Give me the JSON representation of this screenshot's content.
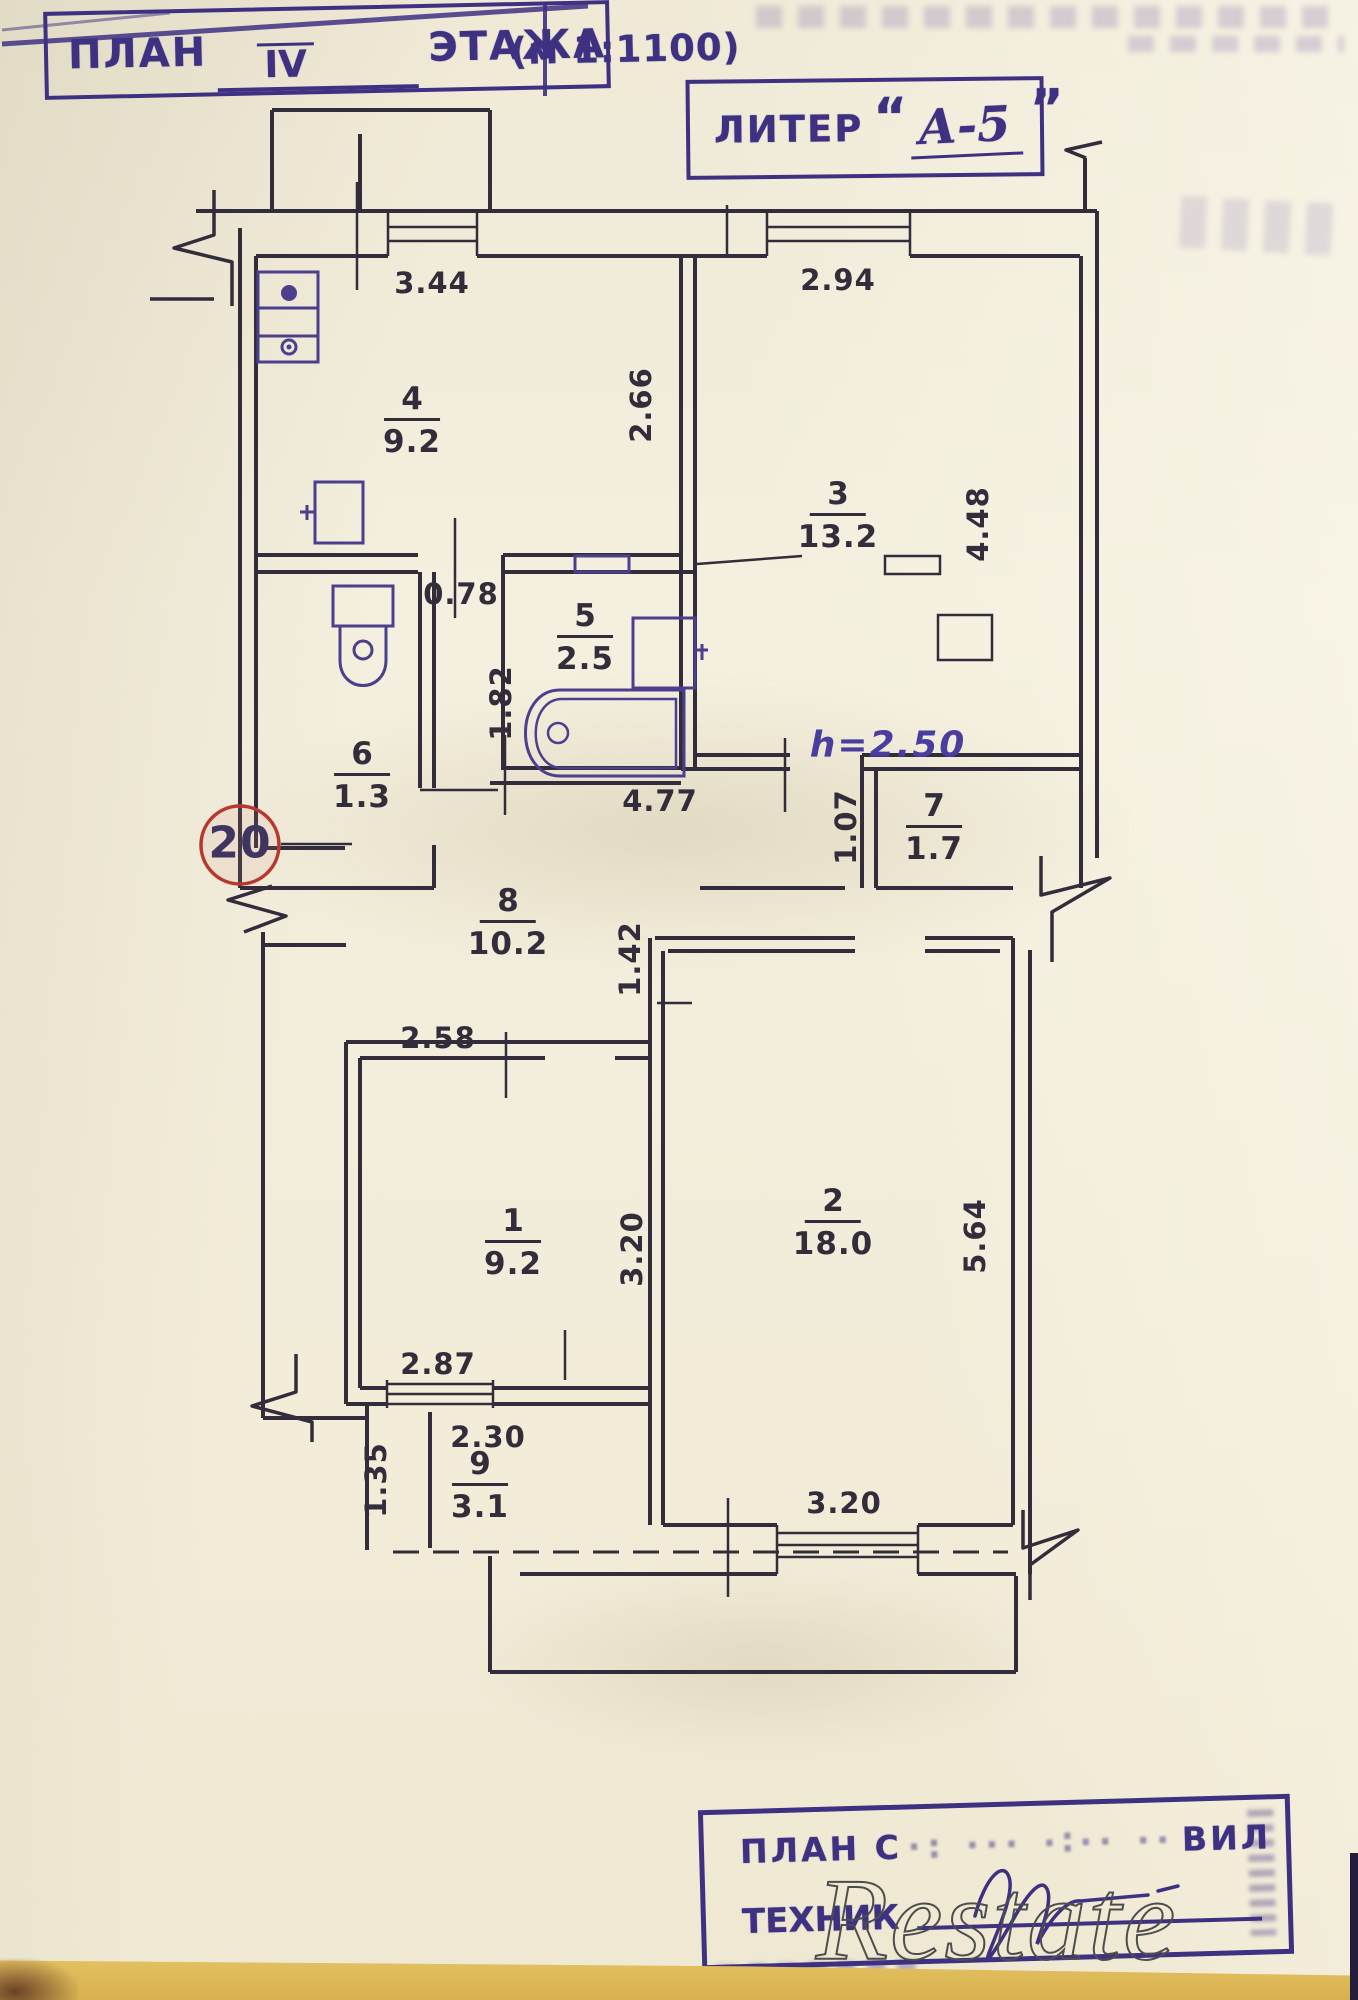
{
  "header_stamp": {
    "word_plan": "ПЛАН",
    "floor_value": "IV",
    "word_floor": "ЭТАЖА",
    "scale_note": "(м 1:1100)"
  },
  "liter_stamp": {
    "label": "ЛИТЕР",
    "quote_open": "“",
    "value": "А-5",
    "quote_close": "”"
  },
  "plan": {
    "apartment_circle": "20",
    "height_note": "h=2.50",
    "rooms": [
      {
        "num": "1",
        "area": "9.2"
      },
      {
        "num": "2",
        "area": "18.0"
      },
      {
        "num": "3",
        "area": "13.2"
      },
      {
        "num": "4",
        "area": "9.2"
      },
      {
        "num": "5",
        "area": "2.5"
      },
      {
        "num": "6",
        "area": "1.3"
      },
      {
        "num": "7",
        "area": "1.7"
      },
      {
        "num": "8",
        "area": "10.2"
      },
      {
        "num": "9",
        "area": "3.1"
      }
    ],
    "dimensions": {
      "top_left": "3.44",
      "top_right": "2.94",
      "kitchen_depth": "2.66",
      "room3_depth": "4.48",
      "passage": "0.78",
      "bath_depth": "1.82",
      "bath_width": "4.77",
      "room7_width": "1.07",
      "hall_width": "1.42",
      "room1_width": "2.58",
      "room1_depth": "3.20",
      "room2_depth": "5.64",
      "balcony_top": "2.87",
      "balcony_inner": "2.30",
      "balcony_depth": "1.35",
      "room2_window": "3.20"
    }
  },
  "bottom_stamp": {
    "line1_start": "ПЛАН С",
    "line1_faded": "·: ··· ·∶·· ··",
    "line1_end": "ВИЛ",
    "line2_label": "ТЕХНИК"
  },
  "watermark": {
    "text": "Restate"
  },
  "colors": {
    "ink": "#332d3b",
    "fixture_ink": "#4b3f8e",
    "stamp": "#3e3182",
    "height_ink": "#4a3da0",
    "red_circle": "#b5392e",
    "watermark_outline": "#4d4d4d",
    "paper": "#f2ecd9",
    "bottom_band": "#e7c76a"
  }
}
